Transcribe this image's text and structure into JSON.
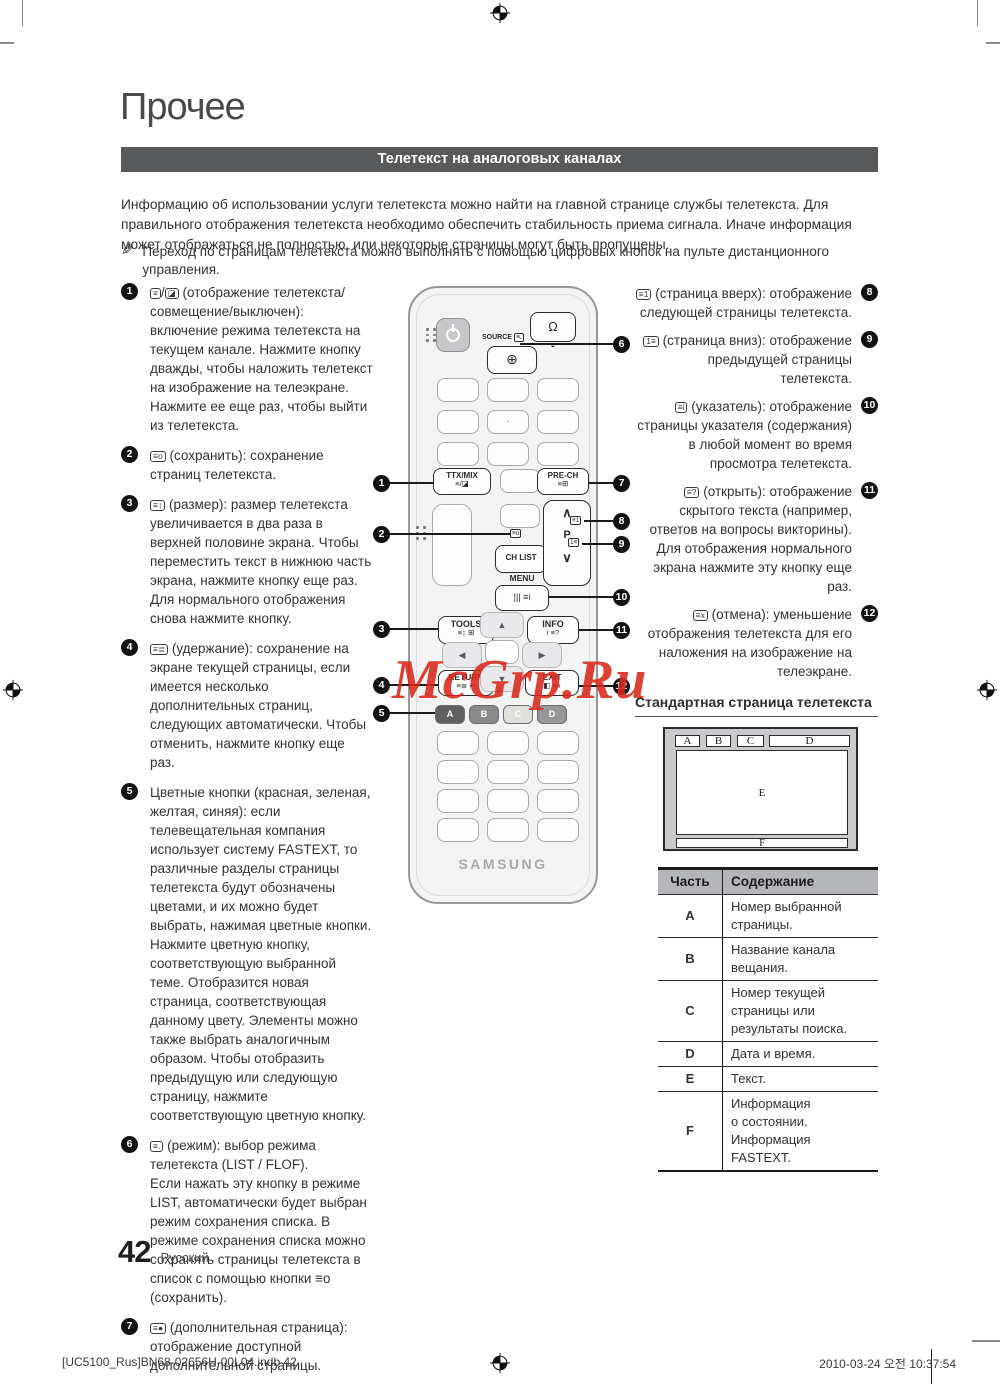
{
  "page": {
    "section_title": "Прочее",
    "banner": "Телетекст на аналоговых каналах",
    "intro": "Информацию об использовании услуги телетекста можно найти на главной странице службы телетекста. Для правильного отображения телетекста необходимо обеспечить стабильность приема сигнала. Иначе информация может отображаться не полностью, или некоторые страницы могут быть пропущены.",
    "note": "Переход по страницам телетекста можно выполнять с помощью цифровых кнопок на пульте дистанционного управления.",
    "page_number": "42",
    "language": "Русский",
    "footer_left": "[UC5100_Rus]BN68-02656H-00L04.indb   42",
    "footer_right": "2010-03-24   오전 10:37:54",
    "watermark": "McGrp.Ru",
    "pencil": "✎"
  },
  "left_items": [
    {
      "num": "1",
      "icon": "≡",
      "sep": "/",
      "icon2": "◪",
      "text": "(отображение телетекста/совмещение/выключен): включение режима телетекста на текущем канале. Нажмите кнопку дважды, чтобы наложить телетекст на изображение на телеэкране. Нажмите ее еще раз, чтобы выйти из телетекста."
    },
    {
      "num": "2",
      "icon": "≡o",
      "text": "(сохранить): сохранение страниц телетекста."
    },
    {
      "num": "3",
      "icon": "≡↕",
      "text": "(размер): размер телетекста увеличивается в два раза в верхней половине экрана. Чтобы переместить текст в нижнюю часть экрана, нажмите кнопку еще раз. Для нормального отображения снова нажмите кнопку."
    },
    {
      "num": "4",
      "icon": "≡≣",
      "text": "(удержание): сохранение на экране текущей страницы, если имеется несколько дополнительных страниц, следующих автоматически. Чтобы отменить, нажмите кнопку еще раз."
    },
    {
      "num": "5",
      "icon": "",
      "text": "Цветные кнопки (красная, зеленая, желтая, синяя): если телевещательная компания использует систему FASTEXT, то различные разделы страницы телетекста будут обозначены цветами, и их можно будет выбрать, нажимая цветные кнопки. Нажмите цветную кнопку, соответствующую выбранной теме. Отобразится новая страница, соответствующая данному цвету. Элементы можно также выбрать аналогичным образом. Чтобы отобразить предыдущую или следующую страницу, нажмите соответствующую цветную кнопку."
    },
    {
      "num": "6",
      "icon": "≡.",
      "text": "(режим): выбор режима телетекста (LIST / FLOF).\nЕсли нажать эту кнопку в режиме LIST, автоматически будет выбран режим сохранения списка. В режиме сохранения списка можно сохранять страницы телетекста в список с помощью кнопки ≡o (сохранить)."
    },
    {
      "num": "7",
      "icon": "≡●",
      "text": "(дополнительная страница): отображение доступной дополнительной страницы."
    }
  ],
  "right_items": [
    {
      "num": "8",
      "icon": "≡1",
      "text": "(страница вверх): отображение следующей страницы телетекста."
    },
    {
      "num": "9",
      "icon": "1≡",
      "text": "(страница вниз): отображение предыдущей страницы телетекста."
    },
    {
      "num": "10",
      "icon": "≡i",
      "text": "(указатель): отображение страницы указателя (содержания) в любой момент во время просмотра телетекста."
    },
    {
      "num": "11",
      "icon": "≡?",
      "text": "(открыть): отображение скрытого текста (например, ответов на вопросы викторины). Для отображения нормального экрана нажмите эту кнопку еще раз."
    },
    {
      "num": "12",
      "icon": "≡x",
      "text": "(отмена): уменьшение отображения телетекста для его наложения на изображение на телеэкране."
    }
  ],
  "remote": {
    "source_label": "SOURCE",
    "source_tag_icon": "≡.",
    "source_btn_icon": "⊕",
    "bulb_icon": "Ω",
    "bulb_minus": "-",
    "num_dot": "·",
    "ttx_label": "TTX/MIX",
    "ttx_icons": "≡/◪",
    "prech_label": "PRE-CH",
    "prech_icons": "≡⊞",
    "save_icon": "≡o",
    "chlist_label": "CH LIST",
    "p_label": "P",
    "p_up": "∧",
    "p_down": "∨",
    "p_up_icon": "≡1",
    "p_down_icon": "1≡",
    "menu_label": "MENU",
    "menu_icons": "||| ≡i",
    "tools_label": "TOOLS",
    "tools_icons": "≡↕ ⊞",
    "info_label": "INFO",
    "info_icons": "i ≡?",
    "return_label": "RETURN",
    "return_icons": "≡≣ ↩",
    "exit_label": "EXIT",
    "exit_icons": "◧ ≡x",
    "up_arrow": "▲",
    "down_arrow": "▼",
    "left_arrow": "◀",
    "right_arrow": "▶",
    "color_buttons": [
      "A",
      "B",
      "C",
      "D"
    ],
    "brand": "SAMSUNG"
  },
  "remote_callouts": [
    "1",
    "2",
    "3",
    "4",
    "5",
    "6",
    "7",
    "8",
    "9",
    "10",
    "11",
    "12"
  ],
  "standard_page": {
    "heading": "Стандартная страница телетекста",
    "regions": [
      "A",
      "B",
      "C",
      "D",
      "E",
      "F"
    ]
  },
  "table": {
    "headers": [
      "Часть",
      "Содержание"
    ],
    "rows": [
      {
        "part": "A",
        "desc": "Номер выбранной\nстраницы."
      },
      {
        "part": "B",
        "desc": "Название канала\nвещания."
      },
      {
        "part": "C",
        "desc": "Номер текущей\nстраницы или\nрезультаты поиска."
      },
      {
        "part": "D",
        "desc": "Дата и время."
      },
      {
        "part": "E",
        "desc": "Текст."
      },
      {
        "part": "F",
        "desc": "Информация\nо состоянии.\nИнформация FASTEXT."
      }
    ]
  }
}
